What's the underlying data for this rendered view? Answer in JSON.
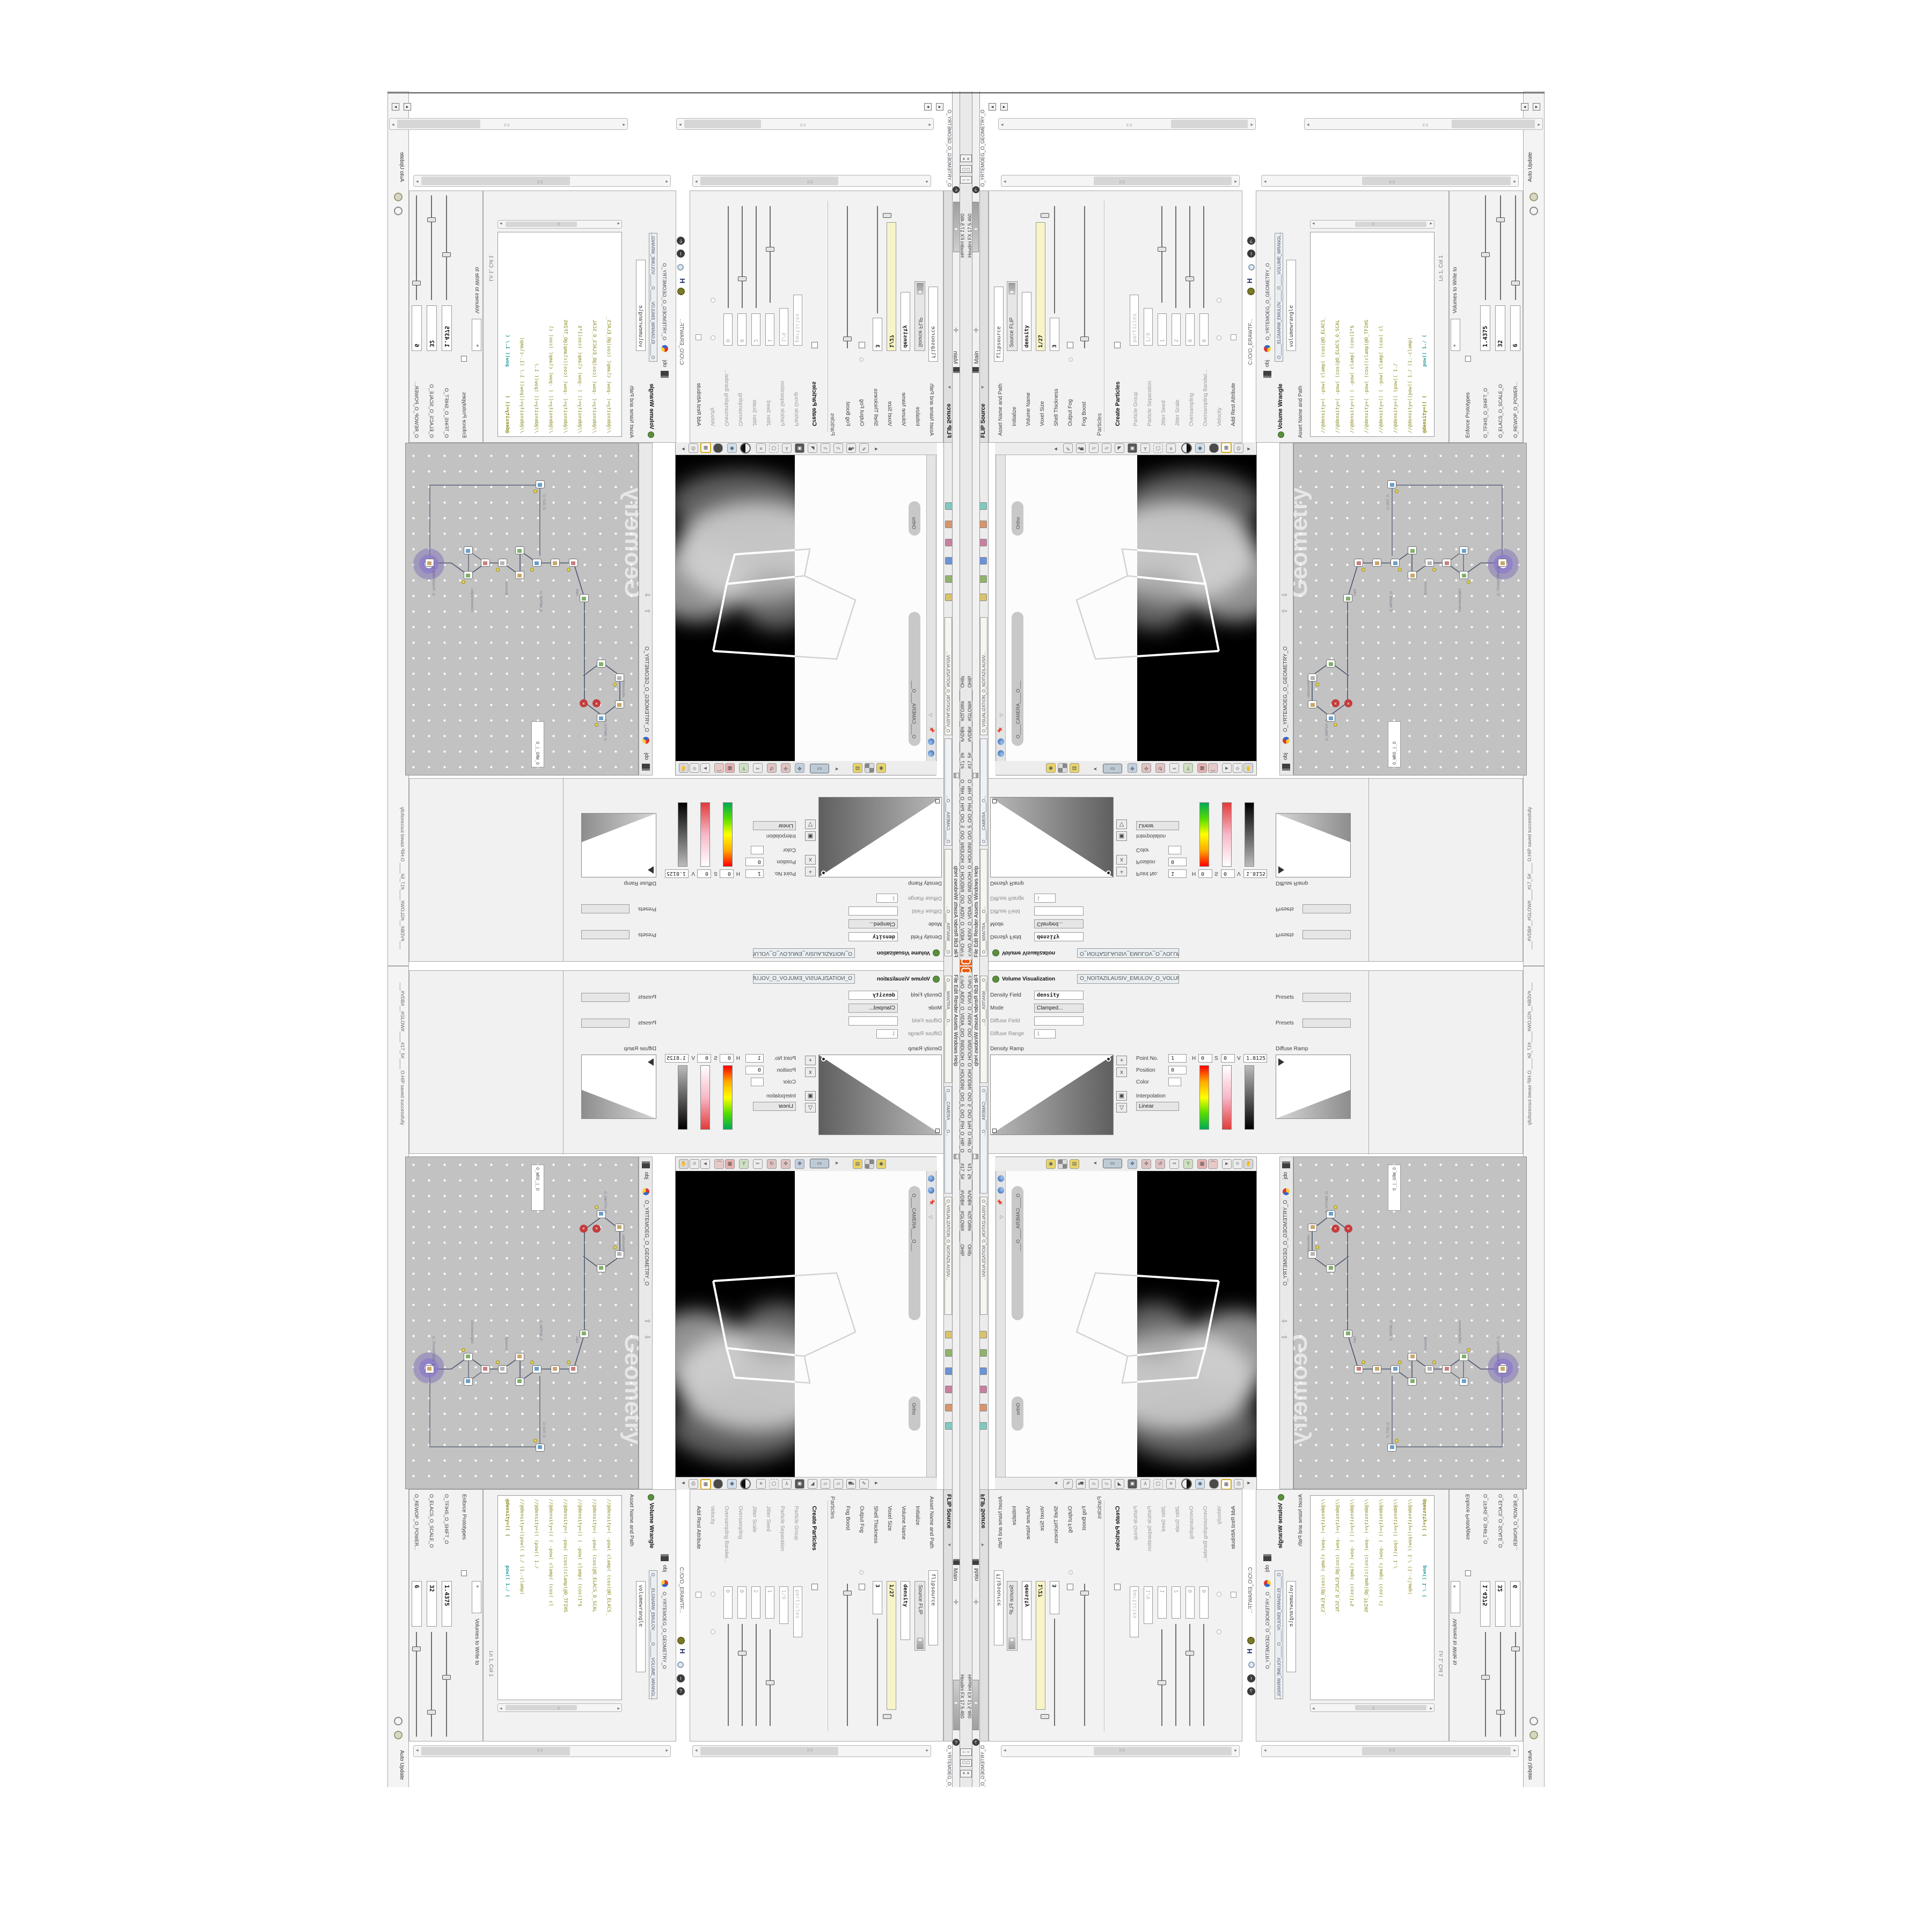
{
  "window": {
    "title": "c:/o/O_AIDIV_O_VIDIA_O/O_INIDUOH_O_HOUDINI_O/O_5_O/O_PIH_O_HIP_O____#17_5#____#VDB#__#GLOW#____ .OHIP",
    "app_version": "Houdini FX 17.5.460",
    "menu": "File   Edit   Render   Assets   Windows   Help",
    "desktop_label": "Main",
    "shelf_tabs": [
      "O____MANTRA____O...",
      "O____CAMERA____O...",
      "O_VISUALIZATION_O_NOITAZILAUSIV..."
    ],
    "minimize": "–",
    "maximize": "□",
    "close": "×"
  },
  "statusbar": {
    "message": "___#VDB#__#GLOW#____#17_5#____ O.HIP saved successfully",
    "auto_update": "Auto Update"
  },
  "flip_source": {
    "header": "FLIP Source",
    "tab": "O_EMULOV_LEHS_ELCITRAP_TICILPMI_DIULF_O_FLUID_IMPLICIT_PARTI...",
    "asset_label": "Asset Name and Path",
    "asset_value": "flipsource",
    "breadcrumb_obj": "obj",
    "net_path": "O_YRTEMOEG_O_GEOMETRY_O",
    "file_path": "C:/O/O_ERAWTF...",
    "fields": [
      {
        "label": "Initialize",
        "value": "Source FLIP"
      },
      {
        "label": "Volume Name",
        "value": "density"
      },
      {
        "label": "Voxel Size",
        "value": "1/27"
      },
      {
        "label": "Shell Thickness",
        "value": "3"
      },
      {
        "label": "Output Fog",
        "value": ""
      },
      {
        "label": "Fog Boost",
        "value": ""
      }
    ],
    "particles_section": "Particles",
    "create_particles": "Create Particles",
    "disabled_values": [
      "particles",
      "1/9"
    ],
    "particle_labels": [
      "Particle Group",
      "Particle Separation",
      "Jitter Seed",
      "Jitter Scale",
      "Oversampling",
      "Oversampling Bandwi...",
      "Velocity",
      "Add Rest Attribute"
    ],
    "particle_values": [
      "1",
      "2",
      "0",
      "0"
    ]
  },
  "volume_wrangle": {
    "header": "Volume Wrangle",
    "tab": "O_____ELGNARW_EMULOV_____O_____VOLUME_WRANGL...",
    "asset_label": "Asset Name and Path",
    "asset_value": "volumewrangle",
    "net_path": "O_YRTEMOEG_O_GEOMETRY_O",
    "file_path": "C:/O/O_ERAWTF...",
    "ln_col": "Ln 1, Col 1",
    "code": [
      "//@density=( -pow( clamp( (cos(@O_ELACS_",
      "//@density=( -pow(      (cos(@O_ELACS_O_SCAL",
      "//@density=((   ( -pow( clamp( (cos(1*$",
      "//@density=( -pow(   (cos((clamp(@O_TFIHS",
      "//@density=((   ( -pow( clamp(  (cos( cl",
      "//@density=((        (pow((      1./",
      "//@density=((pow((   1./ (1.-clamp(",
      "@density=(( ("
    ],
    "code_tail": "pow((  1./ ("
  },
  "sliders_pane": {
    "params": [
      {
        "label": "O_REWOP_O_POWER...",
        "value": "6"
      },
      {
        "label": "O_ELACS_O_SCALE_O",
        "value": "32"
      },
      {
        "label": "O_TFIHS_O_SHIFT_O",
        "value": "1.4375"
      }
    ],
    "write_label": "Volumes to Write to",
    "write_value": "*",
    "enforce_label": "Enforce Prototypes"
  },
  "volume_visualization": {
    "header": "Volume Visualization",
    "tab": "O_NOITAZILAUSIV_EMULOV_O_VOLUME_VISUAL... ",
    "fields": [
      {
        "label": "Density Field",
        "value": "density"
      },
      {
        "label": "Mode",
        "value": "Clamped..."
      },
      {
        "label": "Diffuse Field",
        "value": ""
      },
      {
        "label": "Diffuse Range",
        "value": "1"
      }
    ],
    "density_ramp": "Density Ramp",
    "diffuse_ramp": "Diffuse Ramp",
    "presets": "Presets",
    "point_fields": [
      {
        "label": "Point No.",
        "value": "1"
      },
      {
        "label": "Position",
        "value": "0"
      },
      {
        "label": "Color",
        "value": ""
      },
      {
        "label": "H",
        "value": "0"
      },
      {
        "label": "S",
        "value": "0"
      },
      {
        "label": "V",
        "value": "1.8125"
      },
      {
        "label": "Interpolation",
        "value": "Linear"
      }
    ],
    "buttons": [
      "+",
      "x",
      "▣",
      "▽"
    ]
  },
  "viewport": {
    "camera_pill": "O____CAMERA____O___",
    "ortho_pill": "Ortho",
    "net_path": "O_YRTEMOEG_O_GEOMETRY_O",
    "obj": "obj"
  },
  "network": {
    "watermark": "Geometry",
    "obj": "obj",
    "net_path": "O_YRTEMOEG_O_GEOMETRY_O",
    "badge_field": "O_WRO_|_O",
    "node_labels": [
      "O_TRANSFORM_O...",
      "volumewrangle1",
      "flipsource1",
      "O_MERGE_O",
      "cap1",
      "O_SWITCH_O",
      "vdbsmooth1",
      "O_OUT_O"
    ]
  },
  "colors": {
    "houdini_orange": "#e8590c",
    "network_bg": "#c2c2c2",
    "selection_yellow": "#f7f4c8",
    "code_olive": "#8a8a1e",
    "code_teal": "#2a9d9d",
    "purple_badge": "#7b68b5"
  }
}
